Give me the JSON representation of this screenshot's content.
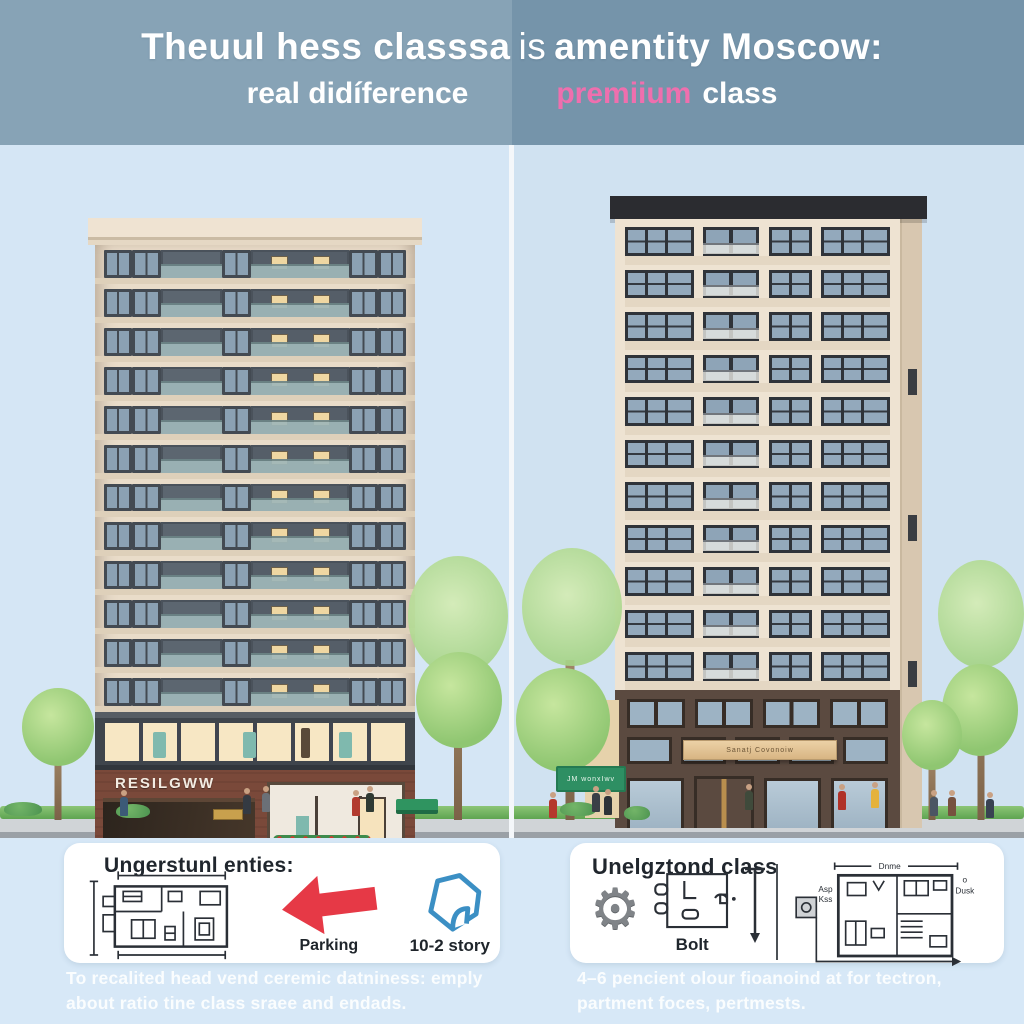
{
  "header": {
    "title_part1": "Theuul hess classsa",
    "title_part2": "is",
    "title_part3": "amentity Moscow:",
    "subtitle_left": "real didíference",
    "subtitle_right_accent": "premiium",
    "subtitle_right_rest": "class",
    "colors": {
      "accent_pink": "#ef6fae",
      "band_left": "#87a3b6",
      "band_right": "#7594aa"
    }
  },
  "scene": {
    "left_building": {
      "sign": "RESILGWW",
      "floors": 12
    },
    "right_building": {
      "awning_text": "Sanatj Covonoiw",
      "floors": 11,
      "street_sign": "JM wonxIwv"
    }
  },
  "cards": {
    "left": {
      "heading": "Ungerstunl enties:",
      "arrow_label": "Parking",
      "house_label": "10-2 story",
      "colors": {
        "arrow_red": "#e63946",
        "house_blue": "#3b8fc4"
      }
    },
    "right": {
      "heading": "Unelgztond class",
      "bolt_label": "Bolt",
      "plan_label_top": "Dnme",
      "plan_label_left1": "Asp",
      "plan_label_left2": "Kss",
      "plan_label_right1": "o",
      "plan_label_right2": "Dusk"
    }
  },
  "captions": {
    "left": "To recalited head vend ceremic datniness: emply about ratio tine class sraee and endads.",
    "right": "4–6 pencient olour fioanoind at for tectron, partment foces, pertmests."
  }
}
